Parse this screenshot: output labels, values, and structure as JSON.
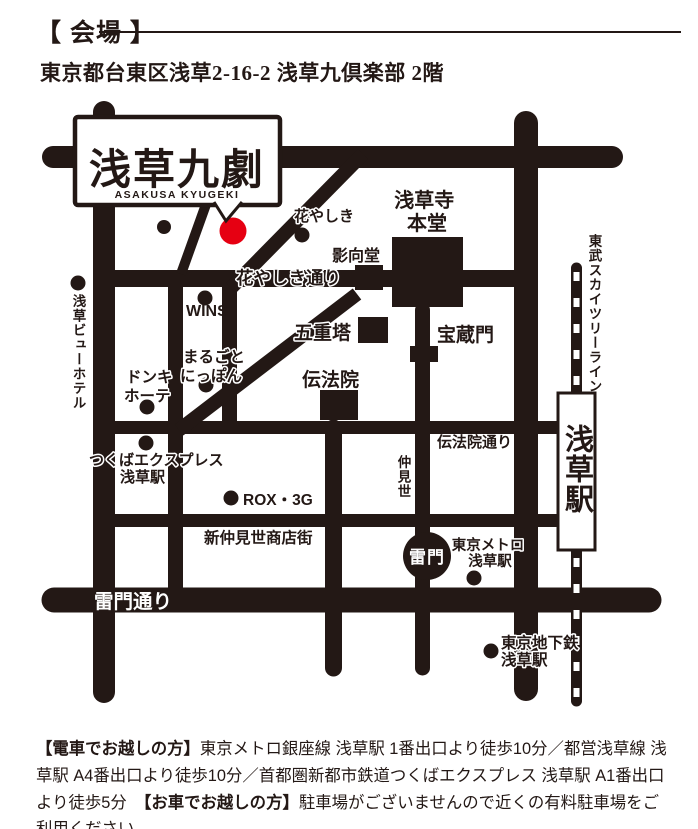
{
  "header": {
    "section_title": "【 会場 】",
    "address": "東京都台東区浅草2-16-2 浅草九倶楽部 2階"
  },
  "venue_box": {
    "name": "浅草九劇",
    "name_en": "ASAKUSA KYUGEKI"
  },
  "map_labels": {
    "hanayashiki": "花やしき",
    "hanayashiki_dori": "花やしき通り",
    "yogodo": "影向堂",
    "sensoji_line1": "浅草寺",
    "sensoji_line2": "本堂",
    "hozomon": "宝蔵門",
    "gojunoto": "五重塔",
    "denboin": "伝法院",
    "wins": "WINS",
    "marugoto_line1": "まるごと",
    "marugoto_line2": "にっぽん",
    "donki_line1": "ドンキ",
    "donki_line2": "ホーテ",
    "view_hotel": "浅草ビューホテル",
    "tsukuba_line1": "つくばエクスプレス",
    "tsukuba_line2": "浅草駅",
    "nakamise": "仲見世",
    "denboin_dori": "伝法院通り",
    "rox": "ROX・3G",
    "shin_nakamise": "新仲見世商店街",
    "kaminarimon_dori": "雷門通り",
    "metro_line1": "東京メトロ",
    "metro_line2": "浅草駅",
    "chikatetsu_line1": "東京地下鉄",
    "chikatetsu_line2": "浅草駅",
    "tobu_skytree_line": "東武スカイツリーライン",
    "kaminarimon": "雷門",
    "asakusa_station": "浅草駅"
  },
  "access": {
    "train_heading": "【電車でお越しの方】",
    "train_text": "東京メトロ銀座線 浅草駅 1番出口より徒歩10分／都営浅草線 浅草駅 A4番出口より徒歩10分／首都圏新都市鉄道つくばエクスプレス 浅草駅 A1番出口より徒歩5分　",
    "car_heading": "【お車でお越しの方】",
    "car_text": "駐車場がございませんので近くの有料駐車場をご利用ください"
  },
  "colors": {
    "ink": "#231815",
    "venue_red": "#e60012",
    "background": "#ffffff"
  }
}
